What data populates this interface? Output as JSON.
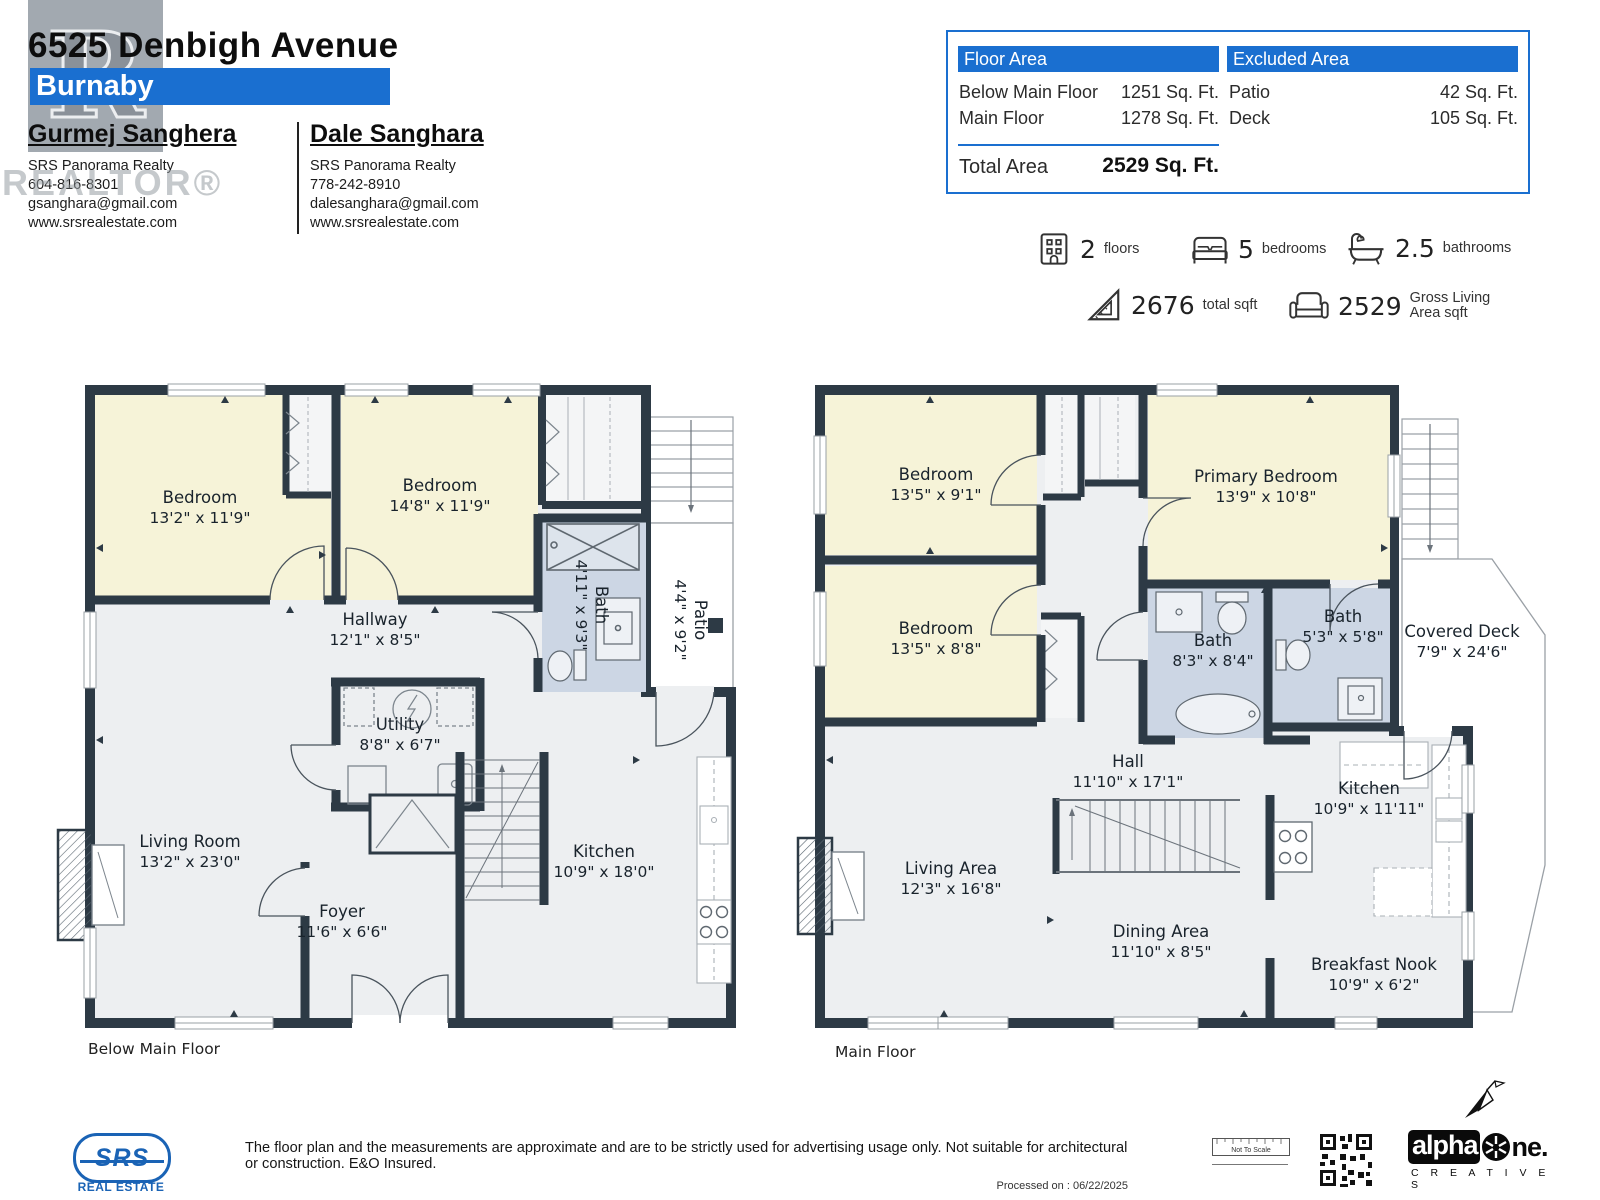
{
  "header": {
    "address": "6525 Denbigh Avenue",
    "city": "Burnaby",
    "watermark": "REALTOR®",
    "watermark_letter": "R",
    "agents": [
      {
        "name": "Gurmej Sanghera",
        "company": "SRS Panorama Realty",
        "phone": "604-816-8301",
        "email": "gsanghara@gmail.com",
        "website": "www.srsrealestate.com"
      },
      {
        "name": "Dale Sanghara",
        "company": "SRS Panorama Realty",
        "phone": "778-242-8910",
        "email": "dalesanghara@gmail.com",
        "website": "www.srsrealestate.com"
      }
    ]
  },
  "area_table": {
    "floor_area_title": "Floor Area",
    "excluded_area_title": "Excluded Area",
    "floor_rows": [
      {
        "label": "Below Main Floor",
        "value": "1251 Sq. Ft."
      },
      {
        "label": "Main Floor",
        "value": "1278 Sq. Ft."
      }
    ],
    "excluded_rows": [
      {
        "label": "Patio",
        "value": "42 Sq. Ft."
      },
      {
        "label": "Deck",
        "value": "105 Sq. Ft."
      }
    ],
    "total_label": "Total Area",
    "total_value": "2529 Sq. Ft."
  },
  "stats": [
    {
      "icon": "building-icon",
      "value": "2",
      "label": "floors"
    },
    {
      "icon": "bed-icon",
      "value": "5",
      "label": "bedrooms"
    },
    {
      "icon": "bathtub-icon",
      "value": "2.5",
      "label": "bathrooms"
    },
    {
      "icon": "ruler-triangle-icon",
      "value": "2676",
      "label": "total sqft"
    },
    {
      "icon": "sofa-icon",
      "value": "2529",
      "label": "Gross Living",
      "label2": "Area sqft"
    }
  ],
  "floors": [
    {
      "label": "Below Main Floor",
      "rooms": [
        {
          "name": "Bedroom",
          "dims": "13'2\" x 11'9\""
        },
        {
          "name": "Bedroom",
          "dims": "14'8\" x 11'9\""
        },
        {
          "name": "Bath",
          "dims": "4'11\" x 9'3\""
        },
        {
          "name": "Patio",
          "dims": "4'4\" x 9'2\""
        },
        {
          "name": "Hallway",
          "dims": "12'1\" x 8'5\""
        },
        {
          "name": "Utility",
          "dims": "8'8\" x 6'7\""
        },
        {
          "name": "Living Room",
          "dims": "13'2\" x 23'0\""
        },
        {
          "name": "Foyer",
          "dims": "11'6\" x 6'6\""
        },
        {
          "name": "Kitchen",
          "dims": "10'9\" x 18'0\""
        }
      ]
    },
    {
      "label": "Main Floor",
      "rooms": [
        {
          "name": "Bedroom",
          "dims": "13'5\" x 9'1\""
        },
        {
          "name": "Primary Bedroom",
          "dims": "13'9\" x 10'8\""
        },
        {
          "name": "Bedroom",
          "dims": "13'5\" x 8'8\""
        },
        {
          "name": "Bath",
          "dims": "8'3\" x 8'4\""
        },
        {
          "name": "Bath",
          "dims": "5'3\" x 5'8\""
        },
        {
          "name": "Covered Deck",
          "dims": "7'9\" x 24'6\""
        },
        {
          "name": "Hall",
          "dims": "11'10\" x 17'1\""
        },
        {
          "name": "Living Area",
          "dims": "12'3\" x 16'8\""
        },
        {
          "name": "Kitchen",
          "dims": "10'9\" x 11'11\""
        },
        {
          "name": "Dining Area",
          "dims": "11'10\" x 8'5\""
        },
        {
          "name": "Breakfast Nook",
          "dims": "10'9\" x 6'2\""
        }
      ]
    }
  ],
  "footer": {
    "srs_logo": "SRS",
    "srs_sub": "REAL ESTATE",
    "disclaimer": "The floor plan and the measurements are approximate and are to be strictly used for advertising usage only. Not suitable for architectural or construction. E&O Insured.",
    "processed": "Processed on : 06/22/2025",
    "not_to_scale": "Not To Scale",
    "alphaone_left": "alpha",
    "alphaone_right": "ne.",
    "alphaone_sub": "C R E A T I V E S"
  },
  "colors": {
    "accent_blue": "#1a6fd0",
    "wall": "#2d3a45",
    "bedroom_fill": "#f6f3d8",
    "bath_fill": "#ccd6e4",
    "floor_fill": "#edeff1"
  }
}
